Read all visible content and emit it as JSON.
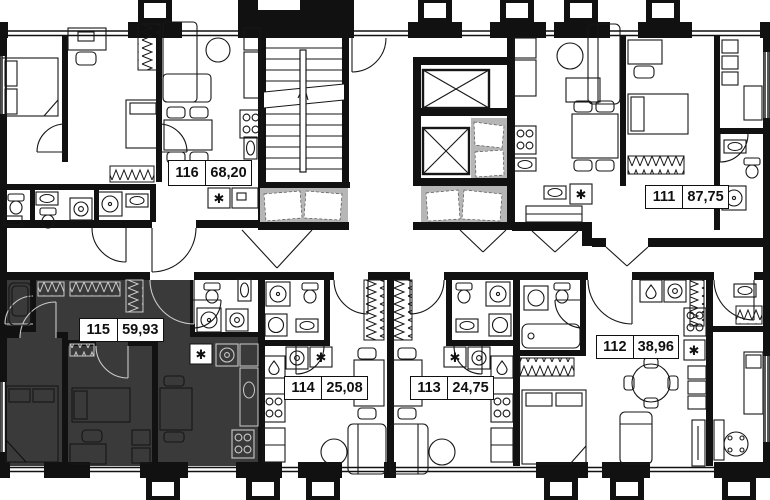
{
  "floorplan": {
    "units": [
      {
        "id": "116",
        "area": "68,20",
        "highlighted": false
      },
      {
        "id": "111",
        "area": "87,75",
        "highlighted": false
      },
      {
        "id": "115",
        "area": "59,93",
        "highlighted": true
      },
      {
        "id": "114",
        "area": "25,08",
        "highlighted": false
      },
      {
        "id": "113",
        "area": "24,75",
        "highlighted": false
      },
      {
        "id": "112",
        "area": "38,96",
        "highlighted": false
      }
    ],
    "colors": {
      "wall": "#111111",
      "highlight_fill": "#3a3a3a",
      "shade": "#b6b6b6",
      "background": "#ffffff"
    },
    "icons": {
      "washing_machine_glyph": "✱"
    }
  }
}
